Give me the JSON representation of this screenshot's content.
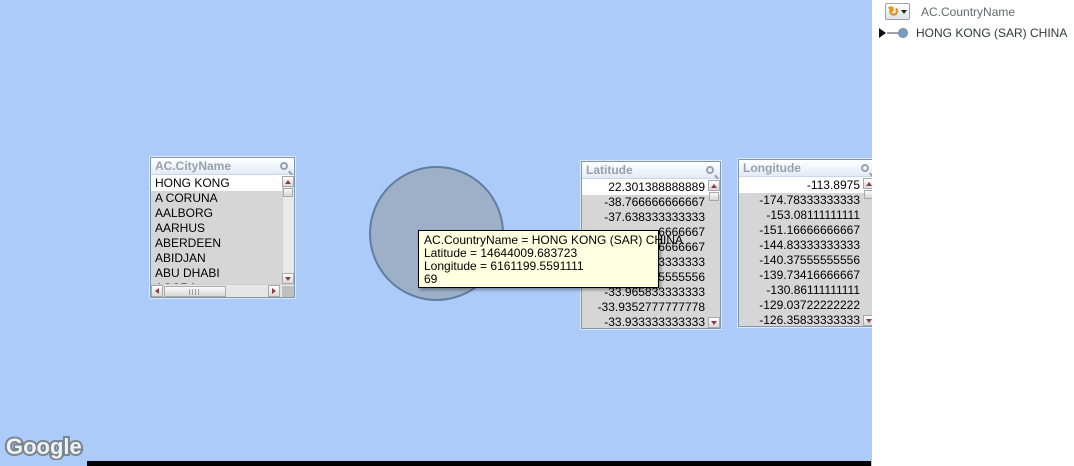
{
  "map": {
    "watermark": "Google",
    "background_color": "#adcbf9",
    "bubble": {
      "fill": "#9db0c7",
      "border": "#5f7ea2"
    }
  },
  "tooltip": {
    "background": "#ffffe1",
    "lines": [
      "AC.CountryName = HONG KONG (SAR) CHINA",
      "Latitude = 14644009.683723",
      "Longitude = 6161199.5591111",
      "69"
    ]
  },
  "listboxes": {
    "city": {
      "title": "AC.CityName",
      "selected": "HONG KONG",
      "items": [
        "HONG KONG",
        "A CORUNA",
        "AALBORG",
        "AARHUS",
        "ABERDEEN",
        "ABIDJAN",
        "ABU DHABI",
        "ACCRA"
      ]
    },
    "latitude": {
      "title": "Latitude",
      "selected": "22.301388888889",
      "items": [
        "22.301388888889",
        "-38.766666666667",
        "-37.638333333333",
        "6666667",
        "66666667",
        "3333333",
        "5555556",
        "-33.965833333333",
        "-33.9352777777778",
        "-33.933333333333"
      ]
    },
    "longitude": {
      "title": "Longitude",
      "selected": "-113.8975",
      "items": [
        "-113.8975",
        "-174.78333333333",
        "-153.08111111111",
        "-151.16666666667",
        "-144.83333333333",
        "-140.37555555556",
        "-139.73416666667",
        "-130.86111111111",
        "-129.03722222222",
        "-126.35833333333"
      ]
    }
  },
  "side_panel": {
    "group_label": "AC.CountryName",
    "selection_label": "HONG KONG (SAR) CHINA",
    "cycle_icon_glyph": "↻"
  }
}
